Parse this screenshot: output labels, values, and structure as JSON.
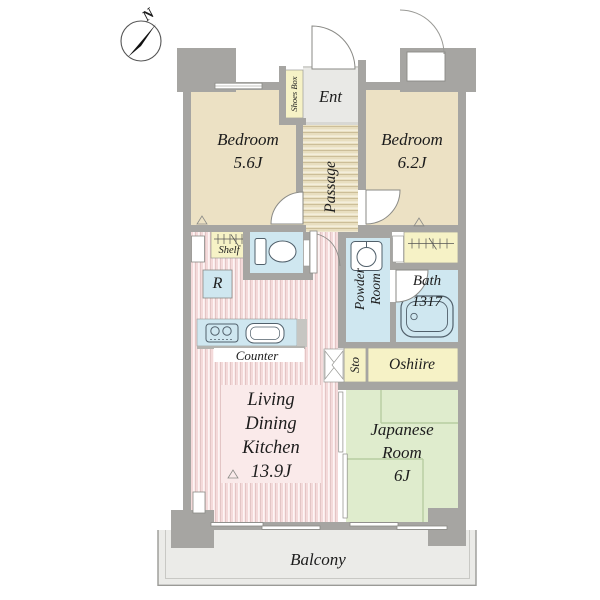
{
  "compass": {
    "north_label": "N"
  },
  "rooms": {
    "bedroom_north": {
      "name": "Bedroom",
      "size": "5.6J"
    },
    "bedroom_east": {
      "name": "Bedroom",
      "size": "6.2J"
    },
    "living_dining_kitchen": {
      "line1": "Living",
      "line2": "Dining",
      "line3": "Kitchen",
      "size": "13.9J"
    },
    "japanese_room": {
      "line1": "Japanese",
      "line2": "Room",
      "size": "6J"
    },
    "bath": {
      "name": "Bath",
      "size": "1317"
    },
    "powder_room": {
      "line1": "Powder",
      "line2": "Room"
    },
    "entrance": {
      "name": "Ent"
    },
    "passage": {
      "name": "Passage"
    },
    "balcony": {
      "name": "Balcony"
    }
  },
  "fixtures": {
    "shoes_box": "Shoes Box",
    "shelf": "Shelf",
    "storage": "Sto",
    "oshiire": "Oshiire",
    "counter": "Counter",
    "refrigerator": "R"
  },
  "colors": {
    "wall": "#a6a5a2",
    "bedroom": "#ece1c4",
    "closet_yellow": "#f6f2c6",
    "water_blue": "#cfe7f0",
    "ldk_pink": "#f4dada",
    "ldk_stripe_light": "#fdf4f4",
    "ldk_stripe_dark": "#dfc0c0",
    "ldk_label_bg": "#faeaea",
    "passage_tan": "#e8debf",
    "passage_stripe_light": "#f4eedb",
    "passage_stripe_dark": "#c9bb94",
    "tatami_green": "#dfeccd",
    "tatami_line": "#b7cda1",
    "balcony_gray": "#ebebe8",
    "ent_gray": "#e9e9e6",
    "icon_stroke": "#51606b",
    "text": "#1c1c1c"
  }
}
